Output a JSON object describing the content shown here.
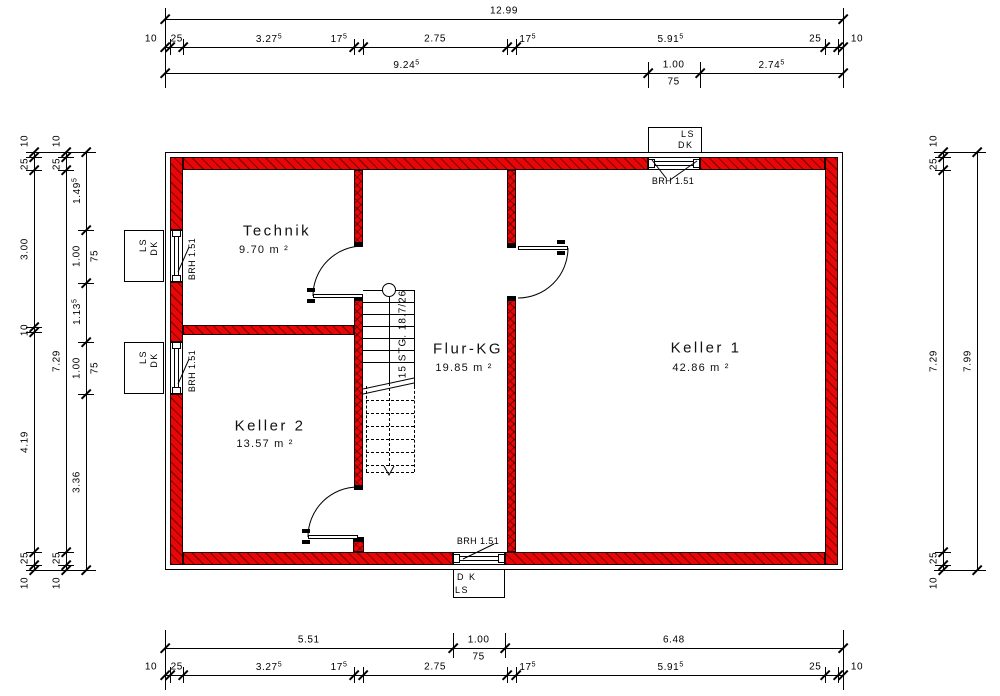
{
  "colors": {
    "wall_red": "#e90606",
    "line": "#000000",
    "background": "#ffffff"
  },
  "plan": {
    "outline": {
      "x": 165,
      "y": 152,
      "w": 678,
      "h": 418
    },
    "walls": [
      {
        "x": 183,
        "y": 157,
        "w": 465,
        "h": 13
      },
      {
        "x": 700,
        "y": 157,
        "w": 125,
        "h": 13
      },
      {
        "x": 183,
        "y": 552,
        "w": 270,
        "h": 13
      },
      {
        "x": 505,
        "y": 552,
        "w": 320,
        "h": 13
      },
      {
        "x": 170,
        "y": 157,
        "w": 13,
        "h": 73
      },
      {
        "x": 170,
        "y": 282,
        "w": 13,
        "h": 60
      },
      {
        "x": 170,
        "y": 394,
        "w": 13,
        "h": 171
      },
      {
        "x": 825,
        "y": 157,
        "w": 13,
        "h": 408
      },
      {
        "x": 354,
        "y": 170,
        "w": 9,
        "h": 77,
        "cross": true
      },
      {
        "x": 354,
        "y": 296,
        "w": 9,
        "h": 194,
        "cross": true
      },
      {
        "x": 353,
        "y": 537,
        "w": 11,
        "h": 15,
        "cross": true
      },
      {
        "x": 507,
        "y": 170,
        "w": 9,
        "h": 77,
        "cross": true
      },
      {
        "x": 507,
        "y": 296,
        "w": 9,
        "h": 256,
        "cross": true
      },
      {
        "x": 183,
        "y": 325,
        "w": 171,
        "h": 10
      }
    ],
    "caps": [
      {
        "x": 354,
        "y": 242,
        "w": 9,
        "h": 5
      },
      {
        "x": 354,
        "y": 296,
        "w": 9,
        "h": 5
      },
      {
        "x": 354,
        "y": 485,
        "w": 9,
        "h": 5
      },
      {
        "x": 353,
        "y": 537,
        "w": 11,
        "h": 5
      },
      {
        "x": 507,
        "y": 243,
        "w": 9,
        "h": 5
      },
      {
        "x": 507,
        "y": 296,
        "w": 9,
        "h": 5
      }
    ],
    "rooms": [
      {
        "name": "Technik",
        "area": "9.70 m ²",
        "nx": 277,
        "ny": 231,
        "ax": 264,
        "ay": 250
      },
      {
        "name": "Keller 2",
        "area": "13.57 m ²",
        "nx": 270,
        "ny": 426,
        "ax": 265,
        "ay": 444
      },
      {
        "name": "Flur-KG",
        "area": "19.85 m ²",
        "nx": 468,
        "ny": 349,
        "ax": 464,
        "ay": 368
      },
      {
        "name": "Keller 1",
        "area": "42.86 m ²",
        "nx": 706,
        "ny": 348,
        "ax": 701,
        "ay": 368
      }
    ],
    "windows": [
      {
        "id": "top",
        "o": "h",
        "x": 648,
        "y": 157,
        "w": 52,
        "h": 13,
        "box": {
          "x": 648,
          "y": 127,
          "w": 54,
          "h": 26
        },
        "box_labels": [
          "LS",
          "DK"
        ],
        "box_align": "right",
        "brh_label": "BRH 1.51",
        "brh": {
          "x": 673,
          "y": 181,
          "rot": false
        },
        "leaders": [
          [
            652,
            160,
            666,
            178
          ],
          [
            697,
            161,
            670,
            180
          ]
        ]
      },
      {
        "id": "bottom",
        "o": "h",
        "x": 453,
        "y": 552,
        "w": 52,
        "h": 13,
        "box": {
          "x": 453,
          "y": 569,
          "w": 52,
          "h": 29
        },
        "box_labels": [
          "D K",
          "LS"
        ],
        "box_align": "left",
        "brh_label": "BRH 1.51",
        "brh": {
          "x": 478,
          "y": 541,
          "rot": false
        },
        "leaders": [
          [
            463,
            559,
            494,
            544
          ]
        ]
      },
      {
        "id": "left-upper",
        "o": "v",
        "x": 170,
        "y": 230,
        "w": 13,
        "h": 52,
        "box": {
          "x": 124,
          "y": 230,
          "w": 40,
          "h": 52
        },
        "box_labels": [
          "LS",
          "DK"
        ],
        "box_align": "rot",
        "brh_label": "BRH 1.51",
        "brh": {
          "x": 192,
          "y": 259,
          "rot": true
        },
        "leaders": [
          [
            178,
            272,
            189,
            247
          ]
        ]
      },
      {
        "id": "left-lower",
        "o": "v",
        "x": 170,
        "y": 342,
        "w": 13,
        "h": 52,
        "box": {
          "x": 124,
          "y": 342,
          "w": 40,
          "h": 52
        },
        "box_labels": [
          "LS",
          "DK"
        ],
        "box_align": "rot",
        "brh_label": "BRH 1.51",
        "brh": {
          "x": 192,
          "y": 371,
          "rot": true
        },
        "leaders": [
          [
            178,
            384,
            189,
            359
          ]
        ]
      }
    ],
    "doors": [
      {
        "id": "technik-door",
        "leaf": {
          "x": 313,
          "y": 294,
          "w": 50,
          "h": 4
        },
        "arc": "M 313 296 A 50 50 0 0 1 363 246",
        "glyph": [
          [
            307,
            288
          ],
          [
            307,
            299
          ]
        ]
      },
      {
        "id": "keller2-door",
        "leaf": {
          "x": 308,
          "y": 535,
          "w": 50,
          "h": 4
        },
        "arc": "M 308 537 A 50 50 0 0 1 358 487",
        "glyph": [
          [
            302,
            529
          ],
          [
            302,
            540
          ]
        ]
      },
      {
        "id": "keller1-door",
        "leaf": {
          "x": 518,
          "y": 246,
          "w": 50,
          "h": 4
        },
        "arc": "M 568 248 A 50 50 0 0 1 518 298",
        "glyph": [
          [
            557,
            240
          ],
          [
            557,
            251
          ]
        ]
      }
    ],
    "stair": {
      "label": "15 STG. 18.7/26",
      "x": 363,
      "right": 414,
      "top": 290,
      "solid_treads": [
        302,
        314,
        326,
        338,
        350,
        362
      ],
      "breaks": [
        "M 363 389 L 414 378",
        "M 363 394 L 414 383"
      ],
      "dashed_treads": [
        400,
        413,
        426,
        439,
        452,
        465
      ],
      "dash_left": 366,
      "dash_right": 414,
      "dash_top": 386,
      "dash_bottom": 472,
      "circle": {
        "cx": 389,
        "cy": 290,
        "r": 7
      },
      "walk": {
        "x": 389,
        "solid": [
          297,
          383
        ],
        "dashed": [
          383,
          466
        ]
      },
      "arrow": "M 384 466 L 389 475 L 394 466",
      "label_pos": {
        "x": 403,
        "y": 334
      }
    }
  },
  "dims": {
    "origin": {
      "x0": 165,
      "y0": 152,
      "sx": 52.194,
      "sy": 52.315
    },
    "horizontal": [
      {
        "y": 19,
        "bounds": [
          0,
          12.99
        ],
        "labels": [
          "12.99"
        ]
      },
      {
        "y": 47,
        "bounds": [
          0,
          0.1,
          0.35,
          3.625,
          3.8,
          6.55,
          6.725,
          12.64,
          12.89,
          12.99
        ],
        "labels": [
          "10",
          "25",
          "3.27^5",
          "17^5",
          "2.75",
          "17^5",
          "5.91^5",
          "25",
          "10"
        ],
        "shift": {
          "0": "start",
          "3": -20,
          "5": 16,
          "7": -16,
          "8": "end"
        }
      },
      {
        "y": 73,
        "bounds": [
          0,
          9.245,
          10.245,
          12.99
        ],
        "labels": [
          "9.24^5",
          "1.00",
          "2.74^5"
        ],
        "subs": {
          "1": "75"
        }
      },
      {
        "y": 648,
        "bounds": [
          0,
          5.51,
          6.51,
          12.99
        ],
        "labels": [
          "5.51",
          "1.00",
          "6.48"
        ],
        "subs": {
          "1": "75"
        }
      },
      {
        "y": 675,
        "bounds": [
          0,
          0.1,
          0.35,
          3.625,
          3.8,
          6.55,
          6.725,
          12.64,
          12.89,
          12.99
        ],
        "labels": [
          "10",
          "25",
          "3.27^5",
          "17^5",
          "2.75",
          "17^5",
          "5.91^5",
          "25",
          "10"
        ],
        "shift": {
          "0": "start",
          "3": -20,
          "5": 16,
          "7": -16,
          "8": "end"
        }
      }
    ],
    "vertical": [
      {
        "x": 34,
        "bounds": [
          0,
          0.1,
          0.35,
          3.35,
          3.45,
          7.64,
          7.89,
          7.99
        ],
        "labels": [
          "10",
          "25",
          "3.00",
          "10",
          "4.19",
          "25",
          "10"
        ],
        "shift": {
          "0": "start",
          "6": "end"
        }
      },
      {
        "x": 66,
        "bounds": [
          0,
          0.1,
          0.35,
          7.64,
          7.89,
          7.99
        ],
        "labels": [
          "10",
          "25",
          "7.29",
          "25",
          "10"
        ],
        "shift": {
          "0": "start",
          "4": "end"
        }
      },
      {
        "x": 86,
        "bounds": [
          0,
          1.495,
          2.495,
          3.63,
          4.63,
          7.99
        ],
        "labels": [
          "1.49^5",
          "1.00",
          "1.13^5",
          "1.00",
          "3.36"
        ],
        "subs": {
          "1": "75",
          "3": "75"
        }
      },
      {
        "x": 943,
        "bounds": [
          0,
          0.1,
          0.35,
          7.64,
          7.89,
          7.99
        ],
        "labels": [
          "10",
          "25",
          "7.29",
          "25",
          "10"
        ],
        "shift": {
          "0": "start",
          "4": "end"
        }
      },
      {
        "x": 977,
        "bounds": [
          0,
          7.99
        ],
        "labels": [
          "7.99"
        ]
      }
    ],
    "ext": [
      {
        "t": "v",
        "x": 165,
        "a": 8,
        "b": 88
      },
      {
        "t": "v",
        "x": 843,
        "a": 8,
        "b": 88
      },
      {
        "t": "v",
        "x": 648,
        "a": 62,
        "b": 88
      },
      {
        "t": "v",
        "x": 700,
        "a": 62,
        "b": 88
      },
      {
        "t": "v",
        "x": 165,
        "a": 630,
        "b": 690
      },
      {
        "t": "v",
        "x": 843,
        "a": 630,
        "b": 690
      },
      {
        "t": "v",
        "x": 453,
        "a": 633,
        "b": 658
      },
      {
        "t": "v",
        "x": 505,
        "a": 633,
        "b": 658
      },
      {
        "t": "h",
        "y": 152,
        "a": 26,
        "b": 96
      },
      {
        "t": "h",
        "y": 570,
        "a": 26,
        "b": 96
      },
      {
        "t": "h",
        "y": 152,
        "a": 934,
        "b": 986
      },
      {
        "t": "h",
        "y": 570,
        "a": 934,
        "b": 986
      }
    ]
  }
}
